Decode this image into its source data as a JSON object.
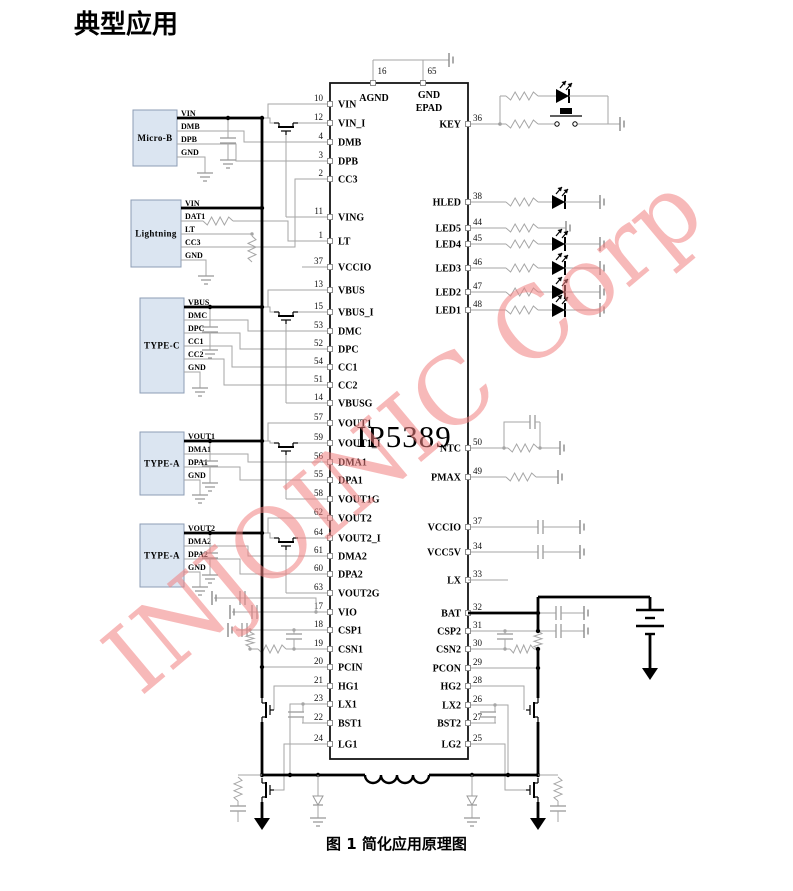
{
  "title": "典型应用",
  "caption": "图 1 简化应用原理图",
  "watermark": "INJOINIC Corp",
  "colors": {
    "wire": "#a6a6a6",
    "component": "#000000",
    "connector_fill": "#dbe5f1",
    "connector_border": "#8c9db5",
    "watermark": "#f08080"
  },
  "ic": {
    "name": "IP5389",
    "top_pins": [
      {
        "num": "16",
        "label": "AGND"
      },
      {
        "num": "65",
        "label": "GND",
        "label2": "EPAD"
      }
    ],
    "left_pins": [
      {
        "num": "10",
        "label": "VIN"
      },
      {
        "num": "12",
        "label": "VIN_I"
      },
      {
        "num": "4",
        "label": "DMB"
      },
      {
        "num": "3",
        "label": "DPB"
      },
      {
        "num": "2",
        "label": "CC3"
      },
      {
        "num": "11",
        "label": "VING"
      },
      {
        "num": "1",
        "label": "LT"
      },
      {
        "num": "37",
        "label": "VCCIO"
      },
      {
        "num": "13",
        "label": "VBUS"
      },
      {
        "num": "15",
        "label": "VBUS_I"
      },
      {
        "num": "53",
        "label": "DMC"
      },
      {
        "num": "52",
        "label": "DPC"
      },
      {
        "num": "54",
        "label": "CC1"
      },
      {
        "num": "51",
        "label": "CC2"
      },
      {
        "num": "14",
        "label": "VBUSG"
      },
      {
        "num": "57",
        "label": "VOUT1"
      },
      {
        "num": "59",
        "label": "VOUT1_I"
      },
      {
        "num": "56",
        "label": "DMA1"
      },
      {
        "num": "55",
        "label": "DPA1"
      },
      {
        "num": "58",
        "label": "VOUT1G"
      },
      {
        "num": "62",
        "label": "VOUT2"
      },
      {
        "num": "64",
        "label": "VOUT2_I"
      },
      {
        "num": "61",
        "label": "DMA2"
      },
      {
        "num": "60",
        "label": "DPA2"
      },
      {
        "num": "63",
        "label": "VOUT2G"
      },
      {
        "num": "17",
        "label": "VIO"
      },
      {
        "num": "18",
        "label": "CSP1"
      },
      {
        "num": "19",
        "label": "CSN1"
      },
      {
        "num": "20",
        "label": "PCIN"
      },
      {
        "num": "21",
        "label": "HG1"
      },
      {
        "num": "23",
        "label": "LX1"
      },
      {
        "num": "22",
        "label": "BST1"
      },
      {
        "num": "24",
        "label": "LG1"
      }
    ],
    "right_pins": [
      {
        "num": "36",
        "label": "KEY"
      },
      {
        "num": "38",
        "label": "HLED"
      },
      {
        "num": "44",
        "label": "LED5"
      },
      {
        "num": "45",
        "label": "LED4"
      },
      {
        "num": "46",
        "label": "LED3"
      },
      {
        "num": "47",
        "label": "LED2"
      },
      {
        "num": "48",
        "label": "LED1"
      },
      {
        "num": "50",
        "label": "NTC"
      },
      {
        "num": "49",
        "label": "PMAX"
      },
      {
        "num": "37",
        "label": "VCCIO"
      },
      {
        "num": "34",
        "label": "VCC5V"
      },
      {
        "num": "33",
        "label": "LX"
      },
      {
        "num": "32",
        "label": "BAT"
      },
      {
        "num": "31",
        "label": "CSP2"
      },
      {
        "num": "30",
        "label": "CSN2"
      },
      {
        "num": "29",
        "label": "PCON"
      },
      {
        "num": "28",
        "label": "HG2"
      },
      {
        "num": "26",
        "label": "LX2"
      },
      {
        "num": "27",
        "label": "BST2"
      },
      {
        "num": "25",
        "label": "LG2"
      }
    ]
  },
  "connectors": [
    {
      "name": "Micro-B",
      "pins": [
        "VIN",
        "DMB",
        "DPB",
        "GND"
      ]
    },
    {
      "name": "Lightning",
      "pins": [
        "VIN",
        "DAT1",
        "LT",
        "CC3",
        "GND"
      ]
    },
    {
      "name": "TYPE-C",
      "pins": [
        "VBUS",
        "DMC",
        "DPC",
        "CC1",
        "CC2",
        "GND"
      ]
    },
    {
      "name": "TYPE-A",
      "pins": [
        "VOUT1",
        "DMA1",
        "DPA1",
        "GND"
      ]
    },
    {
      "name": "TYPE-A",
      "pins": [
        "VOUT2",
        "DMA2",
        "DPA2",
        "GND"
      ]
    }
  ]
}
